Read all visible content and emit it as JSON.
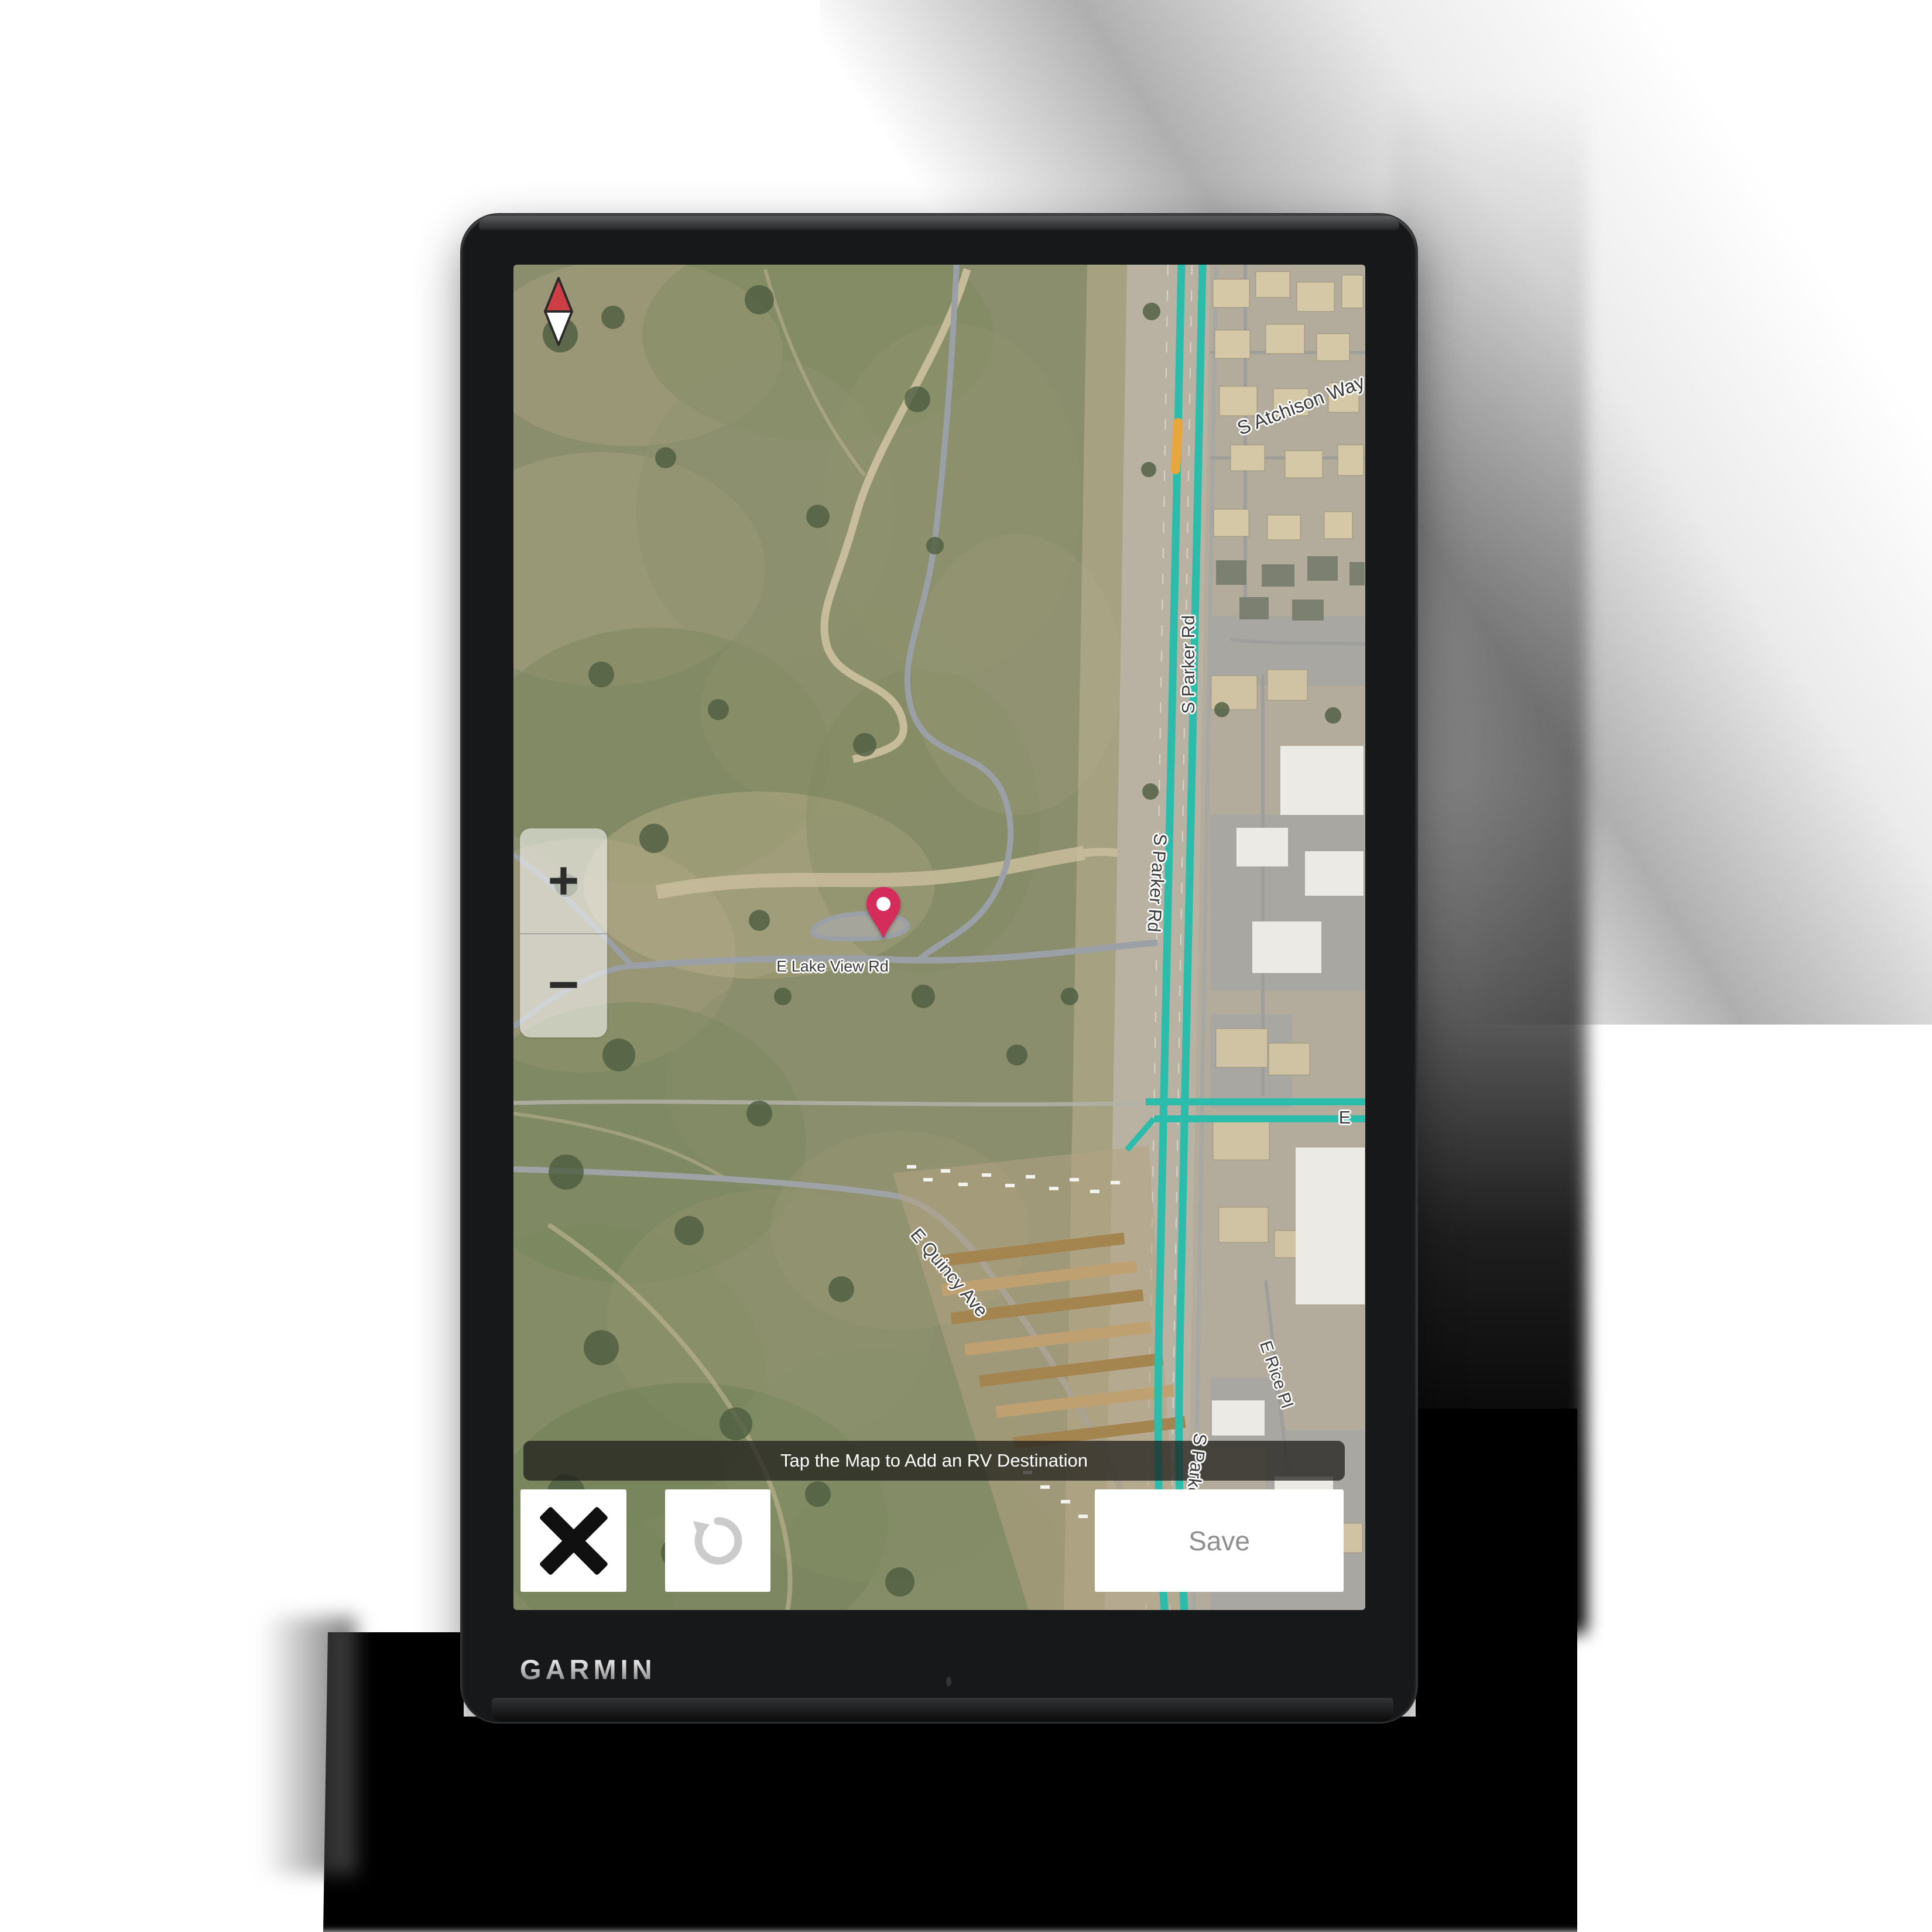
{
  "device": {
    "brand_logo": "GARMIN"
  },
  "screen": {
    "map": {
      "type": "satellite",
      "labels": {
        "lake_view_rd": "E Lake View Rd",
        "parker_rd_upper": "S Parker Rd",
        "parker_rd_mid": "S Parker Rd",
        "parker_rd_bottom": "S Parker Rd",
        "atchison_way": "S Atchison Way",
        "quincy_ave": "E Quincy Ave",
        "rice_pl": "E Rice Pl",
        "east_road_partial": "E"
      },
      "colors": {
        "highway_route": "#2cbcab",
        "traffic_slow_segment": "#e8a63c",
        "destination_pin": "#d62c5c",
        "compass_north": "#cd3f45"
      }
    },
    "controls": {
      "zoom_in": "+",
      "zoom_out": "−",
      "banner": "Tap the Map to Add an RV Destination",
      "cancel_icon": "✕",
      "undo_icon": "↺",
      "save": "Save"
    }
  }
}
